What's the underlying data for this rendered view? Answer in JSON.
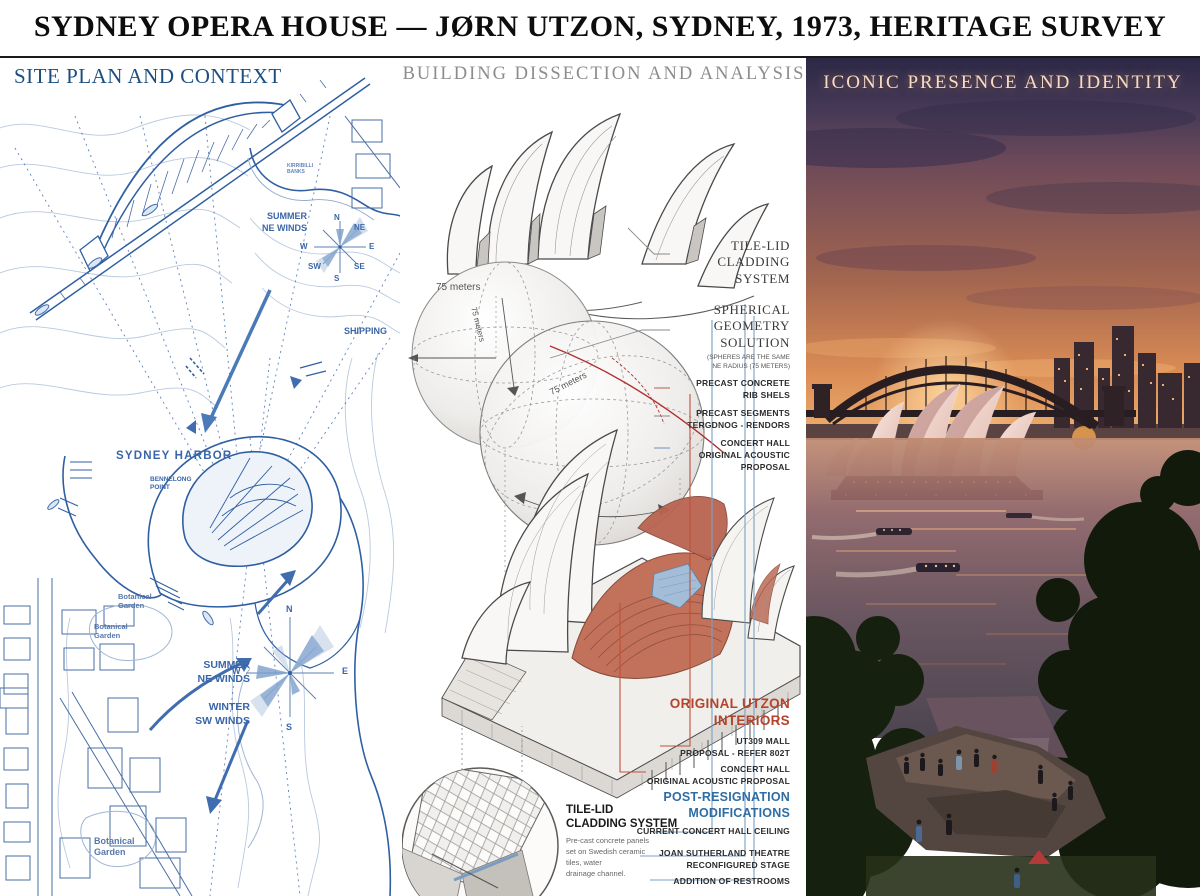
{
  "header": {
    "title": "SYDNEY OPERA HOUSE — JØRN UTZON, SYDNEY, 1973, HERITAGE SURVEY"
  },
  "colors": {
    "map_blue": "#2f5fa3",
    "accent_red": "#b5432c",
    "accent_blue": "#2e6da4"
  },
  "site": {
    "title": "SITE PLAN AND CONTEXT",
    "summer_ne_1": "SUMMER\nNE WINDS",
    "shipping": "SHIPPING",
    "harbor": "SYDNEY HARBOR",
    "bennelong": "BENNELONG\nPOINT",
    "shore": "KIRRIBILLI\nBANKS",
    "summer_ne_2": "SUMMER\nNE WINDS",
    "winter_sw": "WINTER\nSW WINDS",
    "garden_1": "Botanical\nGarden",
    "garden_2": "Botanical\nGarden",
    "garden_3": "Botanical\nGarden",
    "compass1": {
      "n": "N",
      "ne": "NE",
      "e": "E",
      "se": "SE",
      "s": "S",
      "sw": "SW",
      "w": "W"
    },
    "compass2": {
      "n": "N",
      "e": "E",
      "s": "S",
      "w": "W"
    }
  },
  "dissection": {
    "title": "BUILDING DISSECTION AND ANALYSIS",
    "dims": {
      "a": "75 meters",
      "b": "75 meters",
      "c": "75 meters"
    },
    "right_labels": [
      {
        "title": "TILE-LID\nCLADDING\nSYSTEM"
      },
      {
        "title": "SPHERICAL\nGEOMETRY\nSOLUTION",
        "sub": "(SPHERES ARE THE SAME\nNE RADIUS (75 METERS)"
      },
      {
        "title": "PRECAST CONCRETE\nRIB SHELS"
      },
      {
        "title": "PRECAST SEGMENTS\nTERGDNOG - RENDORS"
      },
      {
        "title": "CONCERT HALL\nORIGINAL ACOUSTIC\nPROPOSAL"
      }
    ],
    "interiors": {
      "heading": "ORIGINAL UTZON\nINTERIORS",
      "item1": "UT309 MALL\nPROPOSAL - REFER 802T",
      "item2": "CONCERT HALL\nORIGINAL ACOUSTIC PROPOSAL"
    },
    "modifications": {
      "heading": "POST-RESIGNATION\nMODIFICATIONS",
      "item1": "CURRENT CONCERT HALL CEILING",
      "item2": "JOAN SUTHERLAND THEATRE\nRECONFIGURED STAGE",
      "item3": "ADDITION OF RESTROOMS"
    },
    "inset": {
      "heading": "TILE-LID\nCLADDING SYSTEM",
      "body": "Pre-cast concrete panels\nset on Swedish ceramic\ntiles, water\ndrainage channel."
    }
  },
  "identity": {
    "title": "ICONIC PRESENCE AND IDENTITY"
  }
}
